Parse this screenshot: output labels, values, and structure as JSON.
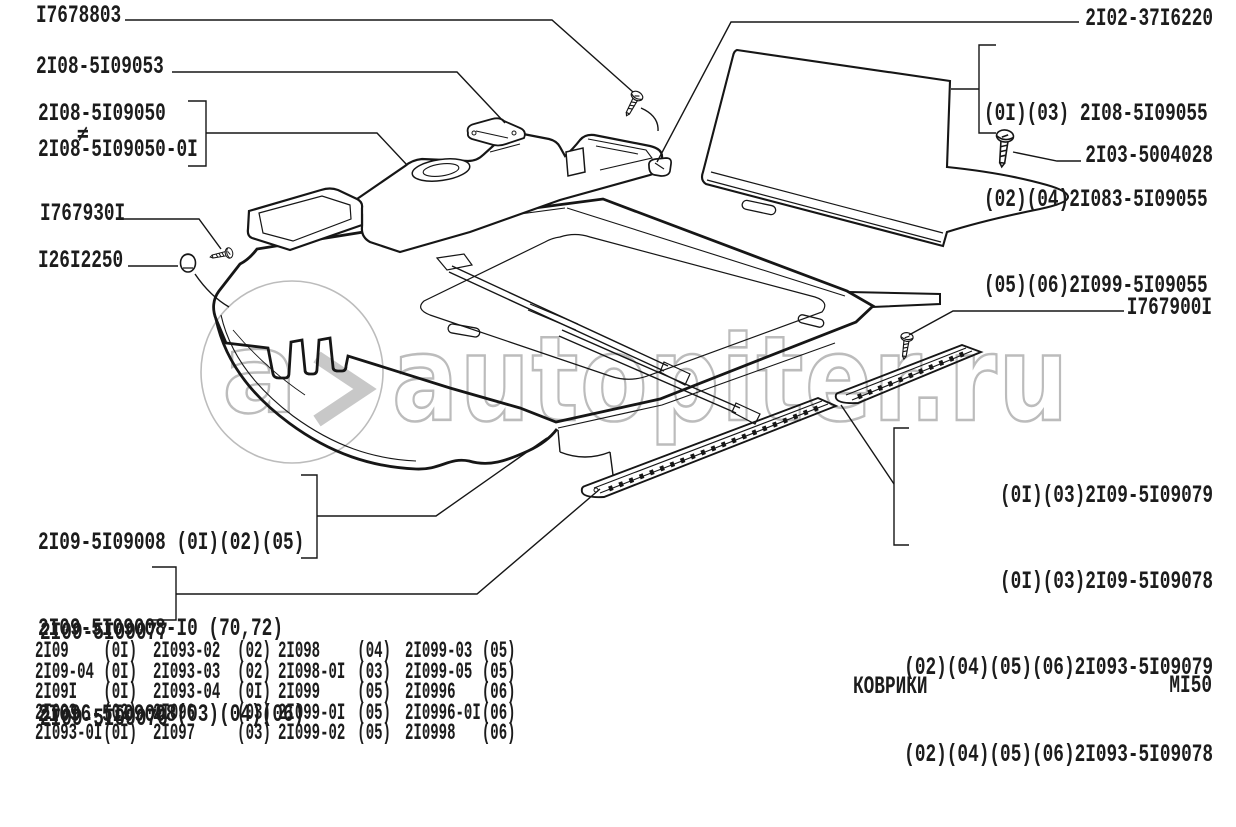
{
  "document": {
    "caption": "КОВРИКИ",
    "sheet_code": "МI50"
  },
  "watermark": {
    "text": "autopiter.ru",
    "logo_letter": "a",
    "color": "#b9b9b9"
  },
  "callouts": {
    "c1": "I7678803",
    "c2": "2I08-5I09053",
    "c3a": "2I08-5I09050",
    "c3_neq": "≠",
    "c3b": "2I08-5I09050-0I",
    "c4": "I767930I",
    "c5": "I26I2250",
    "c6": "2I02-37I6220",
    "c7": "2I03-5004028",
    "c8": "I767900I",
    "top_right_group": [
      "(0I)(03) 2I08-5I09055",
      "(02)(04)2I083-5I09055",
      "(05)(06)2I099-5I09055"
    ],
    "right_group": [
      "(0I)(03)2I09-5I09079",
      "(0I)(03)2I09-5I09078",
      "(02)(04)(05)(06)2I093-5I09079",
      "(02)(04)(05)(06)2I093-5I09078"
    ],
    "left_group": [
      "2I09-5I09008 (0I)(02)(05)",
      "2I09-5I09008-I0 (70,72)",
      "2I096-5I09008(03)(04)(06)"
    ],
    "sill_group": [
      "2I09-5I09077",
      "2I09-5I09076"
    ]
  },
  "table": {
    "columns": [
      [
        {
          "model": "2I09",
          "code": "(0I)"
        },
        {
          "model": "2I09-04",
          "code": "(0I)"
        },
        {
          "model": "2I09I",
          "code": "(0I)"
        },
        {
          "model": "2I093",
          "code": "(02)"
        },
        {
          "model": "2I093-0I",
          "code": "(0I)"
        }
      ],
      [
        {
          "model": "2I093-02",
          "code": "(02)"
        },
        {
          "model": "2I093-03",
          "code": "(02)"
        },
        {
          "model": "2I093-04",
          "code": "(0I)"
        },
        {
          "model": "2I096",
          "code": "(03)"
        },
        {
          "model": "2I097",
          "code": "(03)"
        }
      ],
      [
        {
          "model": "2I098",
          "code": "(04)"
        },
        {
          "model": "2I098-0I",
          "code": "(03)"
        },
        {
          "model": "2I099",
          "code": "(05)"
        },
        {
          "model": "2I099-0I",
          "code": "(05)"
        },
        {
          "model": "2I099-02",
          "code": "(05)"
        }
      ],
      [
        {
          "model": "2I099-03",
          "code": "(05)"
        },
        {
          "model": "2I099-05",
          "code": "(05)"
        },
        {
          "model": "2I0996",
          "code": "(06)"
        },
        {
          "model": "2I0996-0I",
          "code": "(06)"
        },
        {
          "model": "2I0998",
          "code": "(06)"
        }
      ]
    ]
  }
}
